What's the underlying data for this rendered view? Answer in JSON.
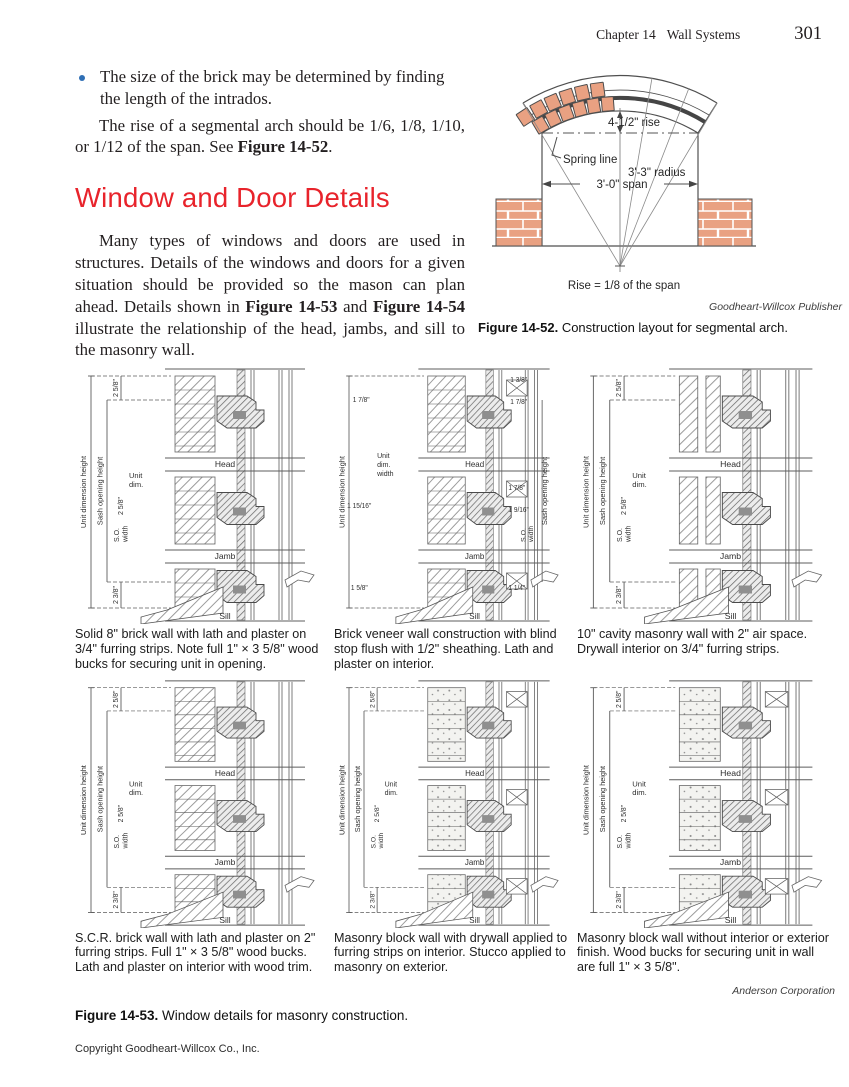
{
  "page": {
    "header": {
      "chapter": "Chapter 14",
      "section": "Wall Systems",
      "page_number": "301"
    },
    "intro": {
      "bullet_text": "The size of the brick may be determined by finding the length of the intrados.",
      "para1_pre": "The rise of a segmental arch should be 1/6, 1/8, 1/10, or 1/12 of the span. See ",
      "para1_bold": "Figure 14-52",
      "para1_post": ".",
      "heading": "Window and Door Details",
      "para2_pre": "Many types of windows and doors are used in structures. Details of the windows and doors for a given situation should be provided so the mason can plan ahead. Details shown in ",
      "para2_bold1": "Figure 14-53",
      "para2_mid": " and ",
      "para2_bold2": "Figure 14-54",
      "para2_post": " illustrate the relationship of the head, jambs, and sill to the masonry wall."
    },
    "figure_52": {
      "labels": {
        "rise": "4-1/2\" rise",
        "spring": "Spring line",
        "radius": "3'-3\" radius",
        "span": "3'-0\" span",
        "note": "Rise = 1/8 of the span"
      },
      "credit": "Goodheart-Willcox Publisher",
      "caption_bold": "Figure 14-52.",
      "caption_text": " Construction layout for segmental arch."
    },
    "figure_53": {
      "panels": [
        {
          "caption": "Solid 8\" brick wall with lath and plaster on 3/4\" furring strips. Note full 1\" × 3 5/8\" wood bucks for securing unit in opening.",
          "labels": {
            "unit_height": "Unit dimension height",
            "sash_height": "Sash opening height",
            "dim_top": "2 5/8\"",
            "dim_mid": "2 5/8\"",
            "dim_bottom": "2 3/8\"",
            "unit_dim": [
              "Unit",
              "dim."
            ],
            "so_width": [
              "S.O.",
              "width"
            ],
            "head": "Head",
            "jamb": "Jamb",
            "sill": "Sill"
          },
          "extra_dims": []
        },
        {
          "caption": "Brick veneer wall construction with blind stop flush with 1/2\" sheathing. Lath and plaster on interior.",
          "labels": {
            "unit_height": "Unit dimension height",
            "sash_height": "Sash opening height",
            "unit_dim": [
              "Unit",
              "dim.",
              "width"
            ],
            "so_width": [
              "S.O.",
              "width"
            ],
            "head": "Head",
            "jamb": "Jamb",
            "sill": "Sill"
          },
          "extra_dims": [
            "1 3/8\"",
            "1 7/8\"",
            "1 7/8\"",
            "1 15/16\"",
            "1 7/8\"",
            "1 9/16\"",
            "1 5/8\"",
            "1 1/4\""
          ]
        },
        {
          "caption": "10\" cavity masonry wall with 2\" air space. Drywall interior on 3/4\" furring strips.",
          "labels": {
            "unit_height": "Unit dimension height",
            "sash_height": "Sash opening height",
            "dim_top": "2 5/8\"",
            "dim_mid": "2 5/8\"",
            "dim_bottom": "2 3/8\"",
            "unit_dim": [
              "Unit",
              "dim."
            ],
            "so_width": [
              "S.O.",
              "width"
            ],
            "head": "Head",
            "jamb": "Jamb",
            "sill": "Sill"
          },
          "extra_dims": []
        },
        {
          "caption": "S.C.R. brick wall with lath and plaster on 2\" furring strips. Full 1\" × 3 5/8\" wood bucks. Lath and plaster on interior with wood trim.",
          "labels": {
            "unit_height": "Unit dimension height",
            "sash_height": "Sash opening height",
            "dim_top": "2 5/8\"",
            "dim_mid": "2 5/8\"",
            "dim_bottom": "2 3/8\"",
            "unit_dim": [
              "Unit",
              "dim."
            ],
            "so_width": [
              "S.O.",
              "width"
            ],
            "head": "Head",
            "jamb": "Jamb",
            "sill": "Sill"
          },
          "extra_dims": []
        },
        {
          "caption": "Masonry block wall with drywall applied to furring strips on interior. Stucco applied to masonry on exterior.",
          "labels": {
            "unit_height": "Unit dimension height",
            "sash_height": "Sash opening height",
            "dim_top": "2 5/8\"",
            "dim_mid": "2 5/8\"",
            "dim_bottom": "2 3/8\"",
            "unit_dim": [
              "Unit",
              "dim."
            ],
            "so_width": [
              "S.O.",
              "width"
            ],
            "head": "Head",
            "jamb": "Jamb",
            "sill": "Sill"
          },
          "extra_dims": []
        },
        {
          "caption": "Masonry block wall without interior or exterior finish. Wood bucks for securing unit in wall are full 1\" × 3 5/8\".",
          "labels": {
            "unit_height": "Unit dimension height",
            "sash_height": "Sash opening height",
            "dim_top": "2 5/8\"",
            "dim_mid": "2 5/8\"",
            "dim_bottom": "2 3/8\"",
            "unit_dim": [
              "Unit",
              "dim."
            ],
            "so_width": [
              "S.O.",
              "width"
            ],
            "head": "Head",
            "jamb": "Jamb",
            "sill": "Sill"
          },
          "extra_dims": []
        }
      ],
      "credit": "Anderson Corporation",
      "caption_bold": "Figure 14-53.",
      "caption_text": " Window details for masonry construction."
    },
    "footer": {
      "copyright": "Copyright Goodheart-Willcox Co., Inc."
    }
  },
  "colors": {
    "accent_red": "#e8232b",
    "bullet_blue": "#2f6fb5",
    "brick": "#e9a182",
    "line_gray": "#5c5c5c"
  }
}
